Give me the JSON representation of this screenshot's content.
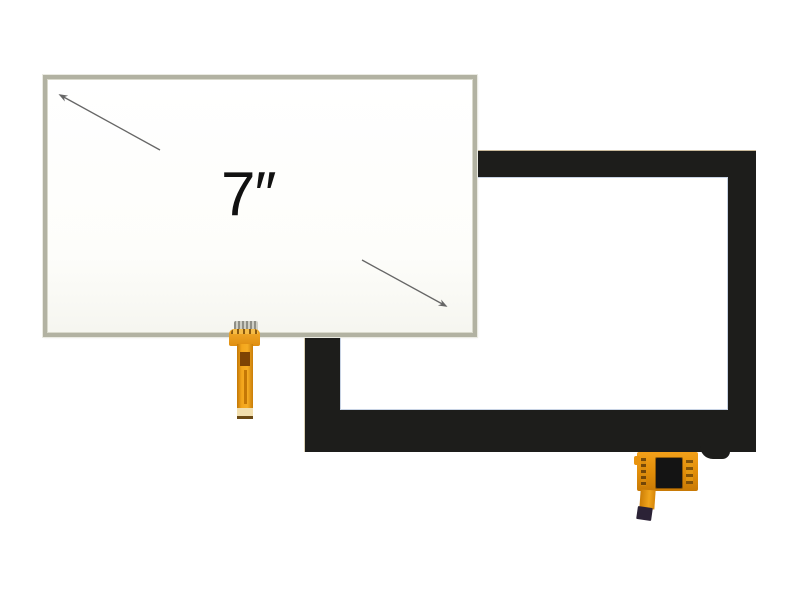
{
  "labels": {
    "size": "7″"
  },
  "colors": {
    "background": "#ffffff",
    "bezel_black": "#1d1d1b",
    "glass_highlight": "#becbdf",
    "resistive_frame": "#b2b2a2",
    "resistive_surface": "#ffffff",
    "busbar_band": "#e6e6de",
    "fpc_orange": "#e8930e",
    "fpc_orange_deep": "#c47806",
    "fpc_tip_dark": "#2b2236",
    "chip_black": "#141414",
    "arrow_gray": "#666666",
    "label_text": "#111111"
  }
}
